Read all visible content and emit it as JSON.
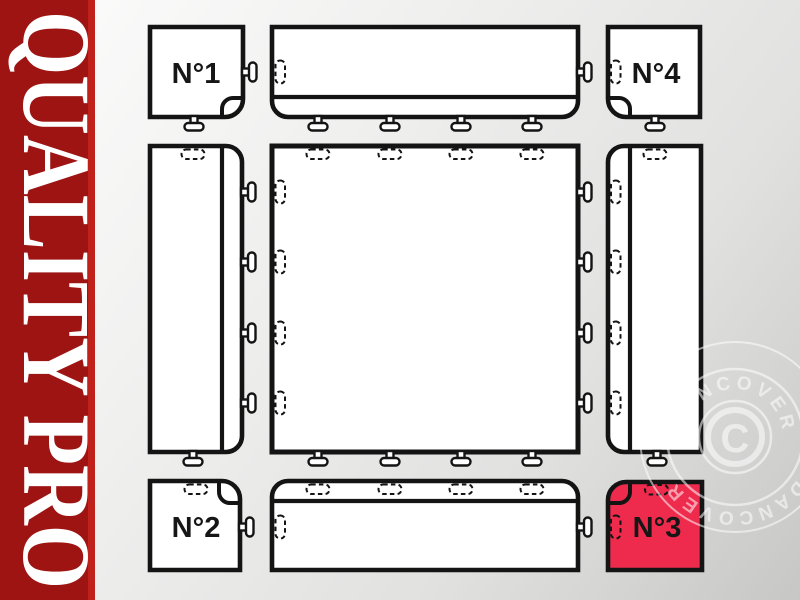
{
  "banner": {
    "text": "QUALITY PRO",
    "bg_color": "#9D1413",
    "edge_color": "#C0221B",
    "text_color": "#FFFFFF"
  },
  "diagram": {
    "corner_labels": {
      "n1": "N°1",
      "n2": "N°2",
      "n3": "N°3",
      "n4": "N°4"
    },
    "highlight_color": "#EE2B4C",
    "outline_color": "#141414",
    "tile_fill": "#FFFFFF"
  },
  "watermark": {
    "ring_text": "DANCOVER",
    "symbol": "C",
    "color": "#FFFFFF"
  }
}
